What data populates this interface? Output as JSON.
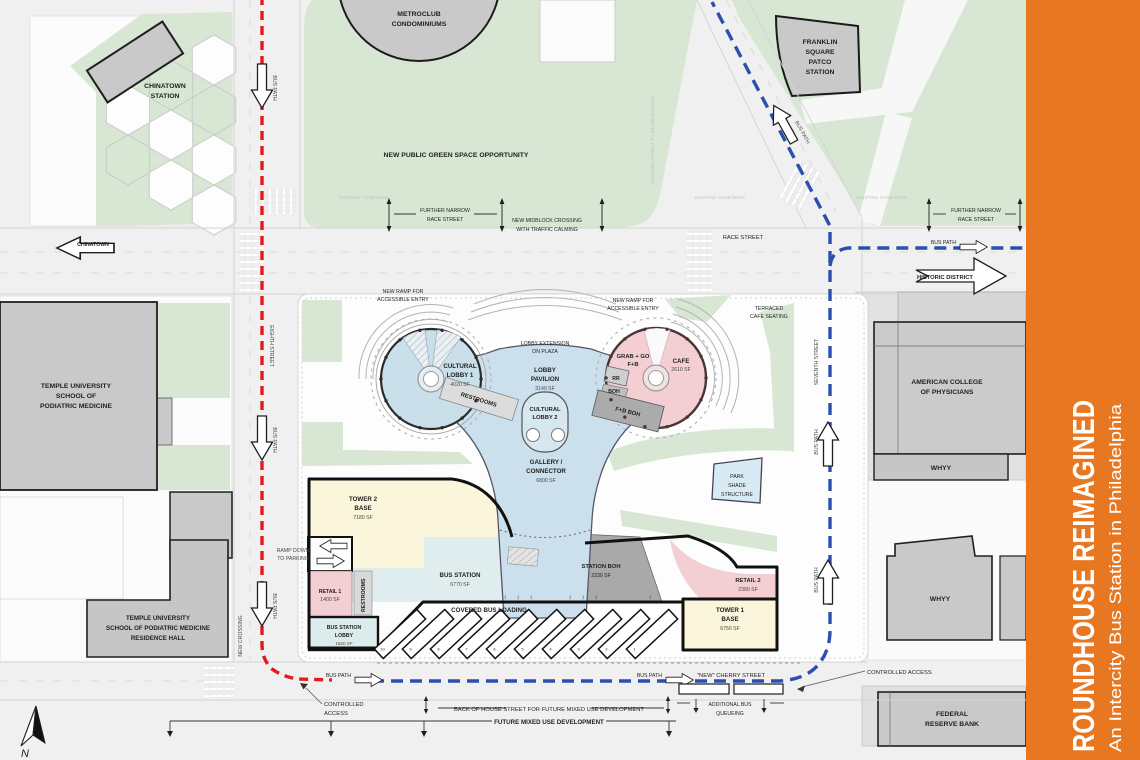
{
  "page": {
    "title_rotated": "ROUNDHOUSE REIMAGINED",
    "subtitle_rotated": "An Intercity Bus Station in Philadelphia"
  },
  "colors": {
    "accent_orange": "#E87722",
    "green_space": "#D7E7D3",
    "lobby_blue": "#C9DFEA",
    "retail_pink": "#F3CFD4",
    "tower_yellow": "#FAF5DB",
    "station_teal": "#E0EDEE",
    "building_gray": "#C9C9C9",
    "bus_path_red": "#E11B1B",
    "bus_path_blue": "#2B4FAE"
  },
  "buildings": {
    "chinatown_station": {
      "lines": [
        "CHINATOWN",
        "STATION"
      ]
    },
    "metroclub": {
      "lines": [
        "METROCLUB",
        "CONDOMINIUMS"
      ]
    },
    "patco": {
      "lines": [
        "FRANKLIN",
        "SQUARE",
        "PATCO",
        "STATION"
      ]
    },
    "temple_sopm": {
      "lines": [
        "TEMPLE UNIVERSITY",
        "SCHOOL OF",
        "PODIATRIC MEDICINE"
      ]
    },
    "temple_residence": {
      "lines": [
        "TEMPLE UNIVERSITY",
        "SCHOOL OF PODIATRIC MEDICINE",
        "RESIDENCE HALL"
      ]
    },
    "acp": {
      "lines": [
        "AMERICAN COLLEGE",
        "OF PHYSICIANS"
      ]
    },
    "whyy_upper": "WHYY",
    "whyy_lower": "WHYY",
    "federal_reserve": {
      "lines": [
        "FEDERAL",
        "RESERVE BANK"
      ]
    }
  },
  "streets": {
    "race": "RACE STREET",
    "eighth": "EIGHTH STREET",
    "seventh": "SEVENTH STREET",
    "cherry": "\"NEW\" CHERRY STREET",
    "new_crossing": "NEW CROSSING",
    "chinatown_arrow": "CHINATOWN",
    "north": "N"
  },
  "routes": {
    "bus_path": "BUS PATH",
    "historic_district": "HISTORIC DISTRICT"
  },
  "annotations": {
    "green_space": "NEW PUBLIC GREEN SPACE OPPORTUNITY",
    "further_narrow": {
      "lines": [
        "FURTHER NARROW",
        "RACE STREET"
      ]
    },
    "midblock": {
      "lines": [
        "NEW MIDBLOCK CROSSING",
        "WITH TRAFFIC CALMING"
      ]
    },
    "existing_curb": "EXISTING CURB EDGE",
    "existing_street": "EXISTING STREET TO BE ABANDONED",
    "new_ramp": {
      "lines": [
        "NEW RAMP FOR",
        "ACCESSIBLE ENTRY"
      ]
    },
    "lobby_extension": {
      "lines": [
        "LOBBY EXTENSION",
        "ON PLAZA"
      ]
    },
    "terraced": {
      "lines": [
        "TERRACED",
        "CAFE SEATING"
      ]
    },
    "controlled_access": "CONTROLLED ACCESS",
    "controlled_access_2": {
      "lines": [
        "CONTROLLED",
        "ACCESS"
      ]
    },
    "boh_street": "BACK OF HOUSE STREET FOR FUTURE MIXED USE DEVELOPMENT",
    "future_mixed": "FUTURE MIXED USE DEVELOPMENT",
    "additional_queue": {
      "lines": [
        "ADDITIONAL BUS",
        "QUEUEING"
      ]
    },
    "ramp_down": {
      "lines": [
        "RAMP DOWN",
        "TO  PARKING"
      ]
    }
  },
  "site": {
    "cultural_lobby_1": {
      "lines": [
        "CULTURAL",
        "LOBBY 1",
        "4020 SF"
      ]
    },
    "lobby_pavilion": {
      "lines": [
        "LOBBY",
        "PAVILION",
        "3140 SF"
      ]
    },
    "cultural_lobby_2": {
      "lines": [
        "CULTURAL",
        "LOBBY 2"
      ]
    },
    "restrooms": "RESTROOMS",
    "restrooms_2": "RESTROOMS",
    "grab_go": {
      "lines": [
        "GRAB + GO",
        "F+B"
      ]
    },
    "cafe": {
      "lines": [
        "CAFE",
        "2610 SF"
      ]
    },
    "rr": "RR",
    "boh": "BOH",
    "fb_boh": "F+B BOH",
    "gallery": {
      "lines": [
        "GALLERY /",
        "CONNECTOR",
        "6800 SF"
      ]
    },
    "tower2": {
      "lines": [
        "TOWER 2",
        "BASE",
        "7180 SF"
      ]
    },
    "retail1": {
      "lines": [
        "RETAIL 1",
        "1400 SF"
      ]
    },
    "bus_station": {
      "lines": [
        "BUS STATION",
        "6770 SF"
      ]
    },
    "station_boh": {
      "lines": [
        "STATION BOH",
        "2330 SF"
      ]
    },
    "covered_loading": "COVERED BUS LOADING",
    "retail2": {
      "lines": [
        "RETAIL 2",
        "2380 SF"
      ]
    },
    "tower1": {
      "lines": [
        "TOWER 1",
        "BASE",
        "6750 SF"
      ]
    },
    "station_lobby": {
      "lines": [
        "BUS STATION",
        "LOBBY",
        "1520 SF"
      ]
    },
    "park_shade": {
      "lines": [
        "PARK",
        "SHADE",
        "STRUCTURE"
      ]
    },
    "bays": [
      "10",
      "9",
      "8",
      "7",
      "6",
      "5",
      "4",
      "3",
      "2",
      "1"
    ]
  }
}
